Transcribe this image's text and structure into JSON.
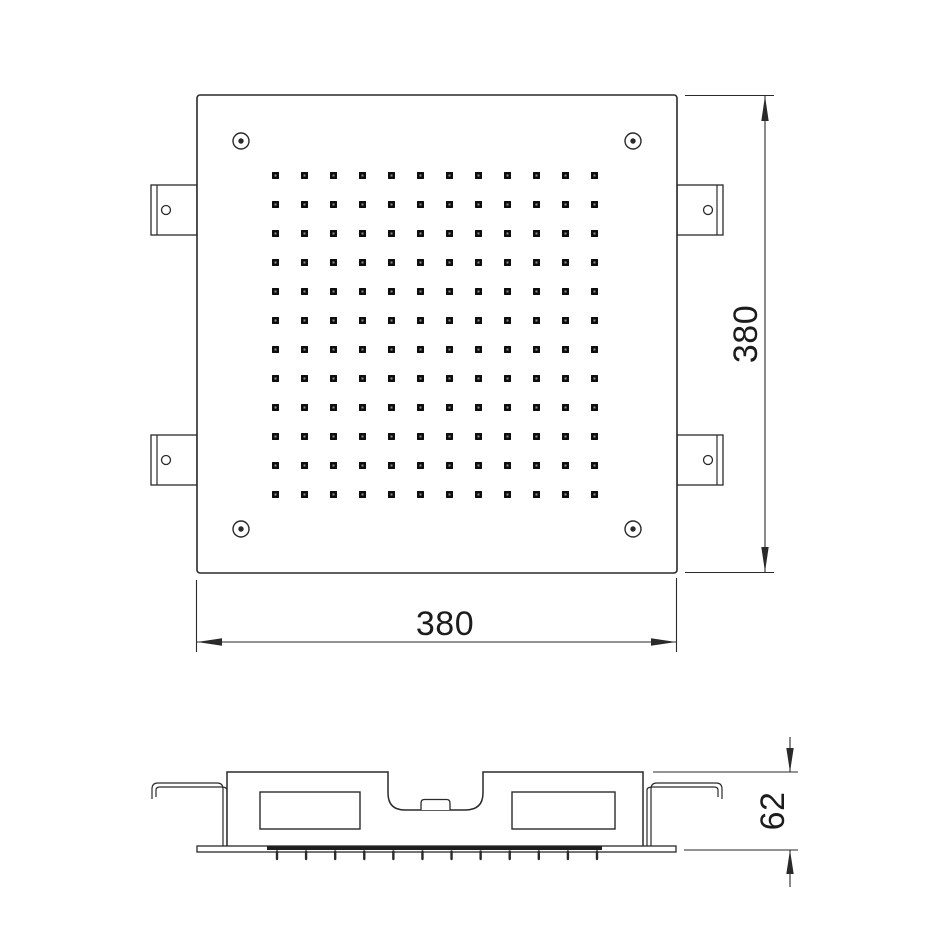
{
  "drawing": {
    "background": "#ffffff",
    "line_color": "#2a2a2a",
    "nozzle_color": "#0d0d0d",
    "nozzle_speck_color": "#8f8f8f",
    "dimensions": {
      "top_view_height_label": "380",
      "top_view_width_label": "380",
      "side_view_height_label": "62"
    },
    "top_view": {
      "plate": {
        "x": 197,
        "y": 95,
        "width": 480,
        "height": 478
      },
      "nozzle_grid": {
        "rows": 12,
        "cols": 12,
        "origin_x": 275.5,
        "origin_y": 175.5,
        "spacing_x": 29,
        "spacing_y": 29,
        "nozzle_size": 7
      },
      "corner_screws": [
        {
          "cx": 241,
          "cy": 141
        },
        {
          "cx": 633,
          "cy": 141
        },
        {
          "cx": 241,
          "cy": 529
        },
        {
          "cx": 633,
          "cy": 529
        }
      ],
      "screw_outer_radius": 8,
      "screw_inner_radius": 2.7,
      "mounting_brackets": [
        {
          "side": "left",
          "top": 185
        },
        {
          "side": "left",
          "top": 435
        },
        {
          "side": "right",
          "top": 185
        },
        {
          "side": "right",
          "top": 435
        }
      ],
      "bracket": {
        "width": 46,
        "height": 50,
        "hole_radius": 4.5
      }
    },
    "side_view": {
      "nozzle_pins": {
        "count": 12,
        "origin_x": 277,
        "spacing_x": 29.09,
        "top_y": 851.5,
        "length": 7.5
      }
    }
  }
}
